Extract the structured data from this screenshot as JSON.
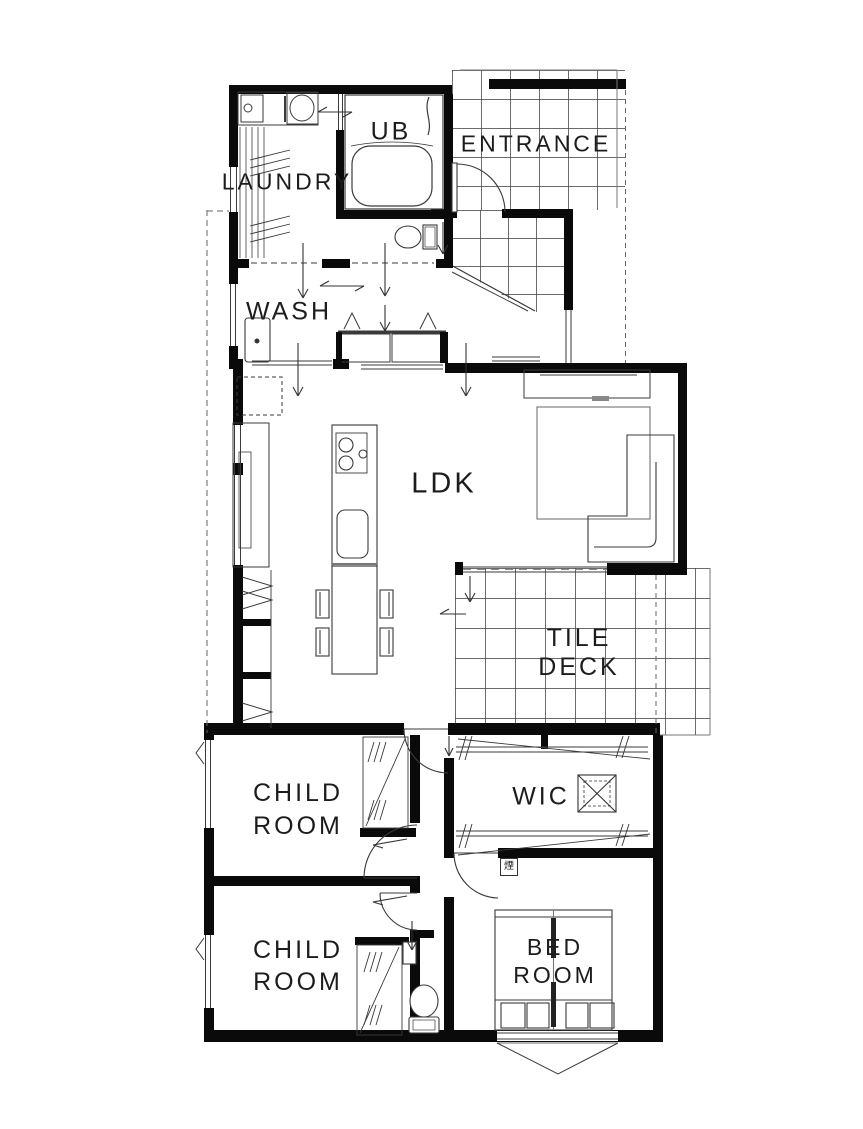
{
  "page": {
    "type": "architectural floor plan",
    "background": "#ffffff"
  },
  "colors": {
    "wall": "#0a0a0a",
    "line": "#3a3a3a",
    "tile_line": "#464646",
    "label": "#1c1c1c",
    "dashed": "#666666"
  },
  "rooms": {
    "laundry": {
      "label": "LAUNDRY"
    },
    "ub": {
      "label": "UB"
    },
    "entrance": {
      "label": "ENTRANCE"
    },
    "wash": {
      "label": "WASH"
    },
    "ldk": {
      "label": "LDK"
    },
    "tile_deck": {
      "line1": "TILE",
      "line2": "DECK"
    },
    "child_room_1": {
      "line1": "CHILD",
      "line2": "ROOM"
    },
    "child_room_2": {
      "line1": "CHILD",
      "line2": "ROOM"
    },
    "wic": {
      "label": "WIC"
    },
    "bed_room": {
      "line1": "BED",
      "line2": "ROOM"
    }
  },
  "annotations": {
    "smoke_detector": "煙"
  },
  "fixtures": {
    "laundry": [
      "laundry-sink",
      "washing-machine",
      "drying-rack"
    ],
    "ub": [
      "bathtub"
    ],
    "toilet_upper": [
      "toilet"
    ],
    "toilet_lower": [
      "toilet",
      "hand-basin"
    ],
    "wash": [
      "wash-basin"
    ],
    "ldk": [
      "refrigerator-space",
      "kitchen-back-counter",
      "kitchen-island",
      "cooktop",
      "kitchen-sink",
      "dining-table",
      "dining-chairs",
      "tv-board",
      "rug",
      "l-shaped-sofa",
      "storage-shelves"
    ],
    "hall": [
      "closets",
      "door-swings"
    ],
    "wic": [
      "hanger-rails",
      "attic-access-hatch"
    ],
    "bed_room": [
      "double-bed"
    ],
    "child_rooms": [
      "closets",
      "casement-windows"
    ]
  }
}
